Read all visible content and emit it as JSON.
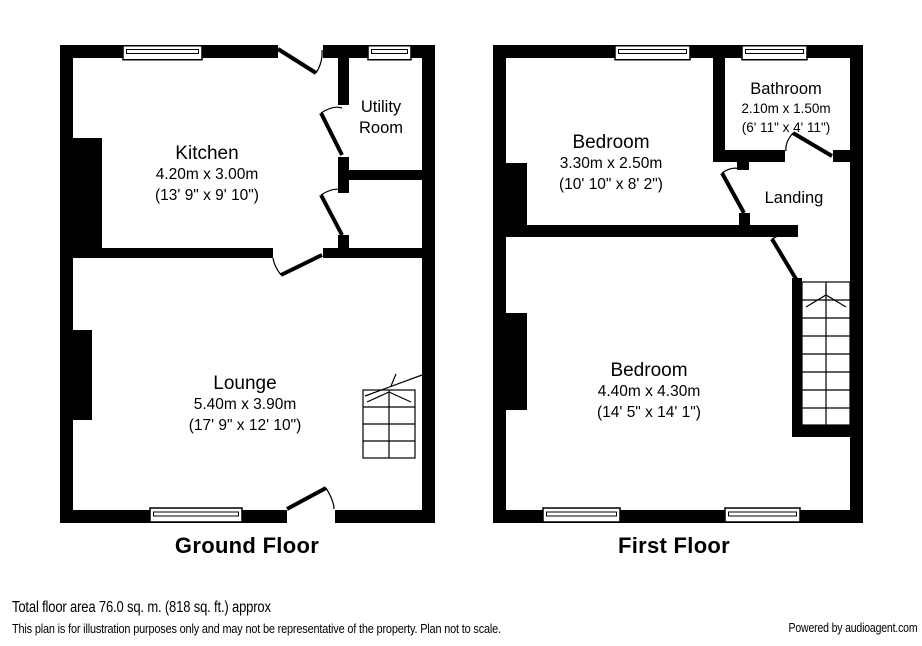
{
  "ground_floor": {
    "title": "Ground Floor",
    "rooms": {
      "kitchen": {
        "name": "Kitchen",
        "dims_metric": "4.20m x 3.00m",
        "dims_imperial": "(13' 9\" x 9' 10\")"
      },
      "utility": {
        "name_line1": "Utility",
        "name_line2": "Room"
      },
      "lounge": {
        "name": "Lounge",
        "dims_metric": "5.40m x 3.90m",
        "dims_imperial": "(17' 9\" x 12' 10\")"
      }
    }
  },
  "first_floor": {
    "title": "First Floor",
    "rooms": {
      "bedroom1": {
        "name": "Bedroom",
        "dims_metric": "3.30m x 2.50m",
        "dims_imperial": "(10' 10\" x 8' 2\")"
      },
      "bathroom": {
        "name": "Bathroom",
        "dims_metric": "2.10m x 1.50m",
        "dims_imperial": "(6' 11\" x 4' 11\")"
      },
      "landing": {
        "name": "Landing"
      },
      "bedroom2": {
        "name": "Bedroom",
        "dims_metric": "4.40m x 4.30m",
        "dims_imperial": "(14' 5\" x 14' 1\")"
      }
    }
  },
  "footer": {
    "total_area": "Total floor area 76.0 sq. m. (818 sq. ft.) approx",
    "disclaimer": "This plan is for illustration purposes only and may not be representative of the property. Plan not to scale.",
    "powered_by": "Powered by audioagent.com"
  },
  "colors": {
    "wall": "#000000",
    "background": "#ffffff",
    "text": "#000000"
  }
}
